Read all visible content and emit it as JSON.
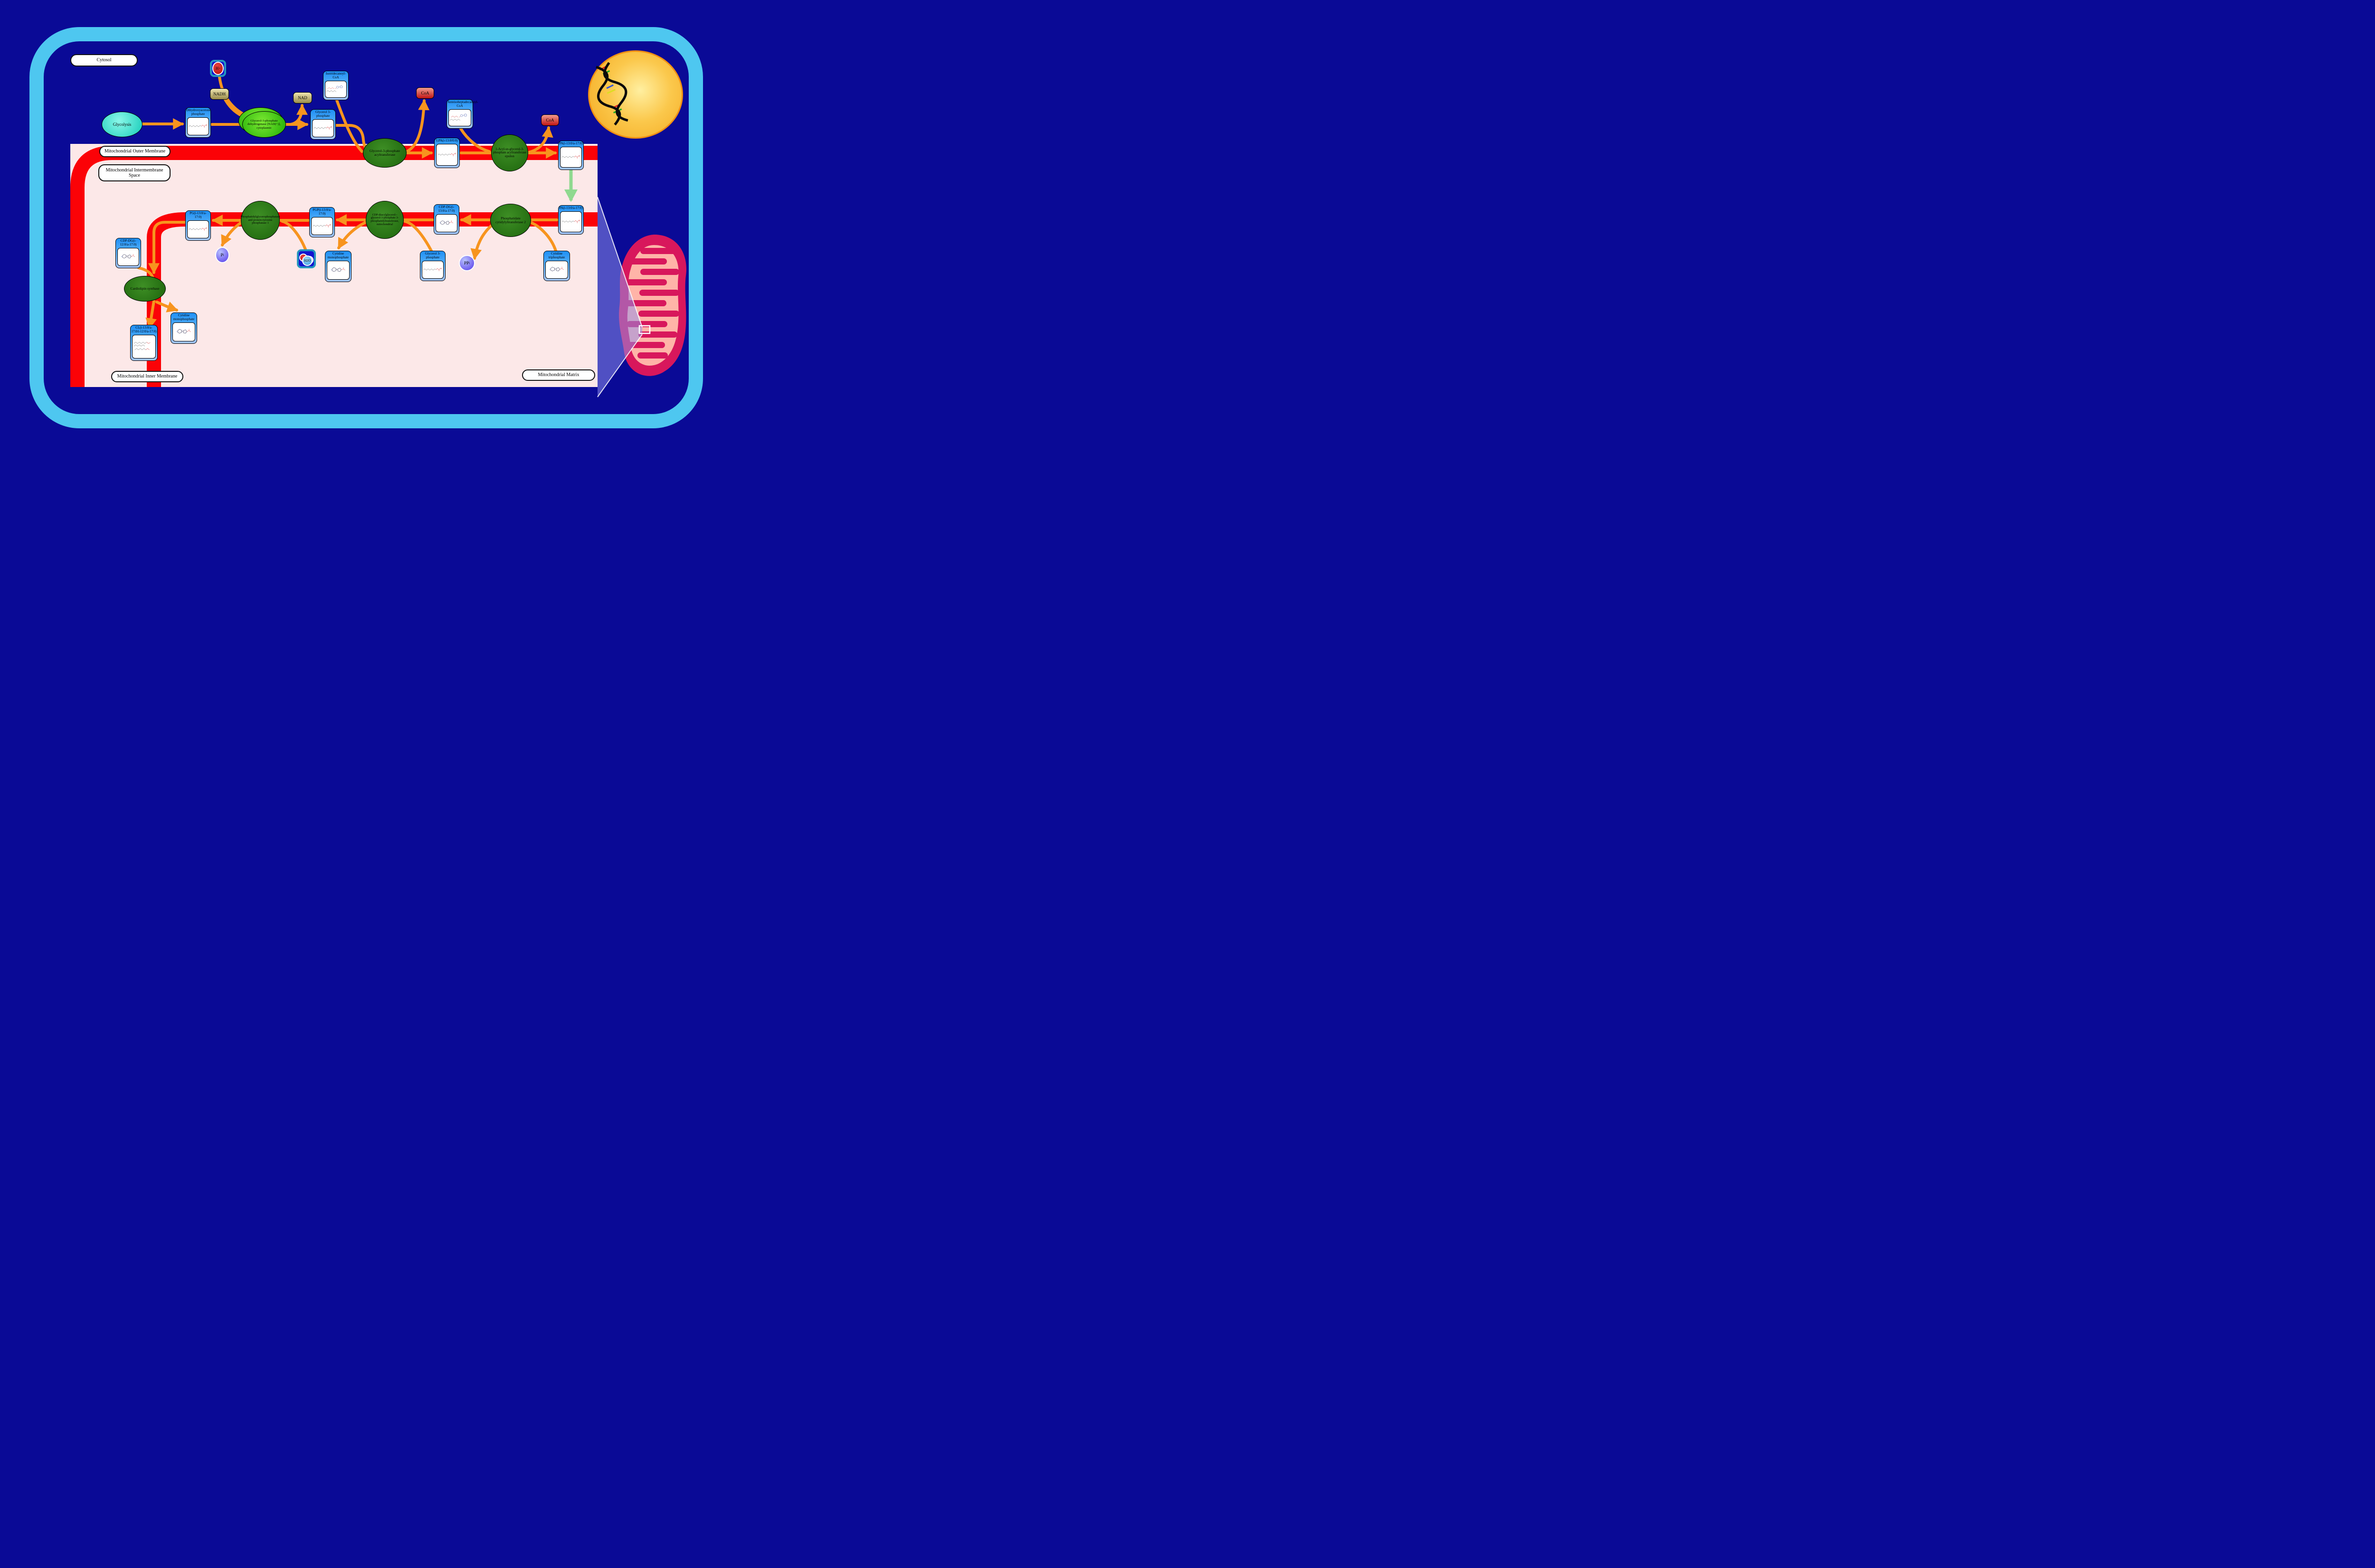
{
  "colors": {
    "background": "#0A0A96",
    "cell_membrane": "#4EC7F0",
    "intermembrane_space": "#FCE8E8",
    "membrane_band": "#FB0207",
    "reaction_arrow": "#F7941E",
    "transport_arrow": "#8FD98F",
    "metabolite_header": "#1E8FF5",
    "membrane_enzyme": "#2E7D1F",
    "cytosolic_enzyme": "#35D31A",
    "nucleus": "#F3A81E",
    "mitochondrion_outer": "#D8175C",
    "mitochondrion_matrix": "#FFB4A8"
  },
  "regions": {
    "cytosol": "Cytosol",
    "outer_membrane": "Mitochondrial Outer Membrane",
    "intermembrane_space": "Mitochondrial Intermembrane Space",
    "inner_membrane": "Mitochondrial Inner Membrane",
    "matrix": "Mitochondrial Matrix"
  },
  "pathway": {
    "glycolysis": "Glycolysis",
    "metabolites": {
      "dhap": "Dihydroxyacetone phosphate",
      "g3p_cytosol": "Glycerol 3-phosphate",
      "isotridecanoyl_coa": "Isotridecanoyl-CoA",
      "lpa": "LPA(i-13:0/0:0)",
      "anteisoheptadecanoyl_coa": "Anteisoheptadecanoyl-CoA",
      "pa_outer": "PA(i-13:0/a-17:0)",
      "pa_inner": "PA(i-13:0/a-17:0)",
      "cdp_dg_13": "CDP-DG(i-13:0/a-17:0)",
      "pgp": "PGP(i-13:0/a-17:0)",
      "pg": "PG(i-13:0/a-17:0)",
      "cdp_dg_12": "CDP-DG(i-12:0/a-17:0)",
      "cl": "CL(i-13:0/a-17:0/i-12:0/a-17:0)",
      "cmp_left": "Cytidine monophosphate",
      "cmp_middle": "Cytidine monophosphate",
      "g3p_matrix": "Glycerol 3-phosphate",
      "ctp": "Cytidine triphosphate"
    },
    "enzymes": {
      "g3p_dehydrogenase": "Glycerol-3-phosphate dehydrogenase [NAD(+)], cytoplasmic",
      "g3p_acyltransferase": "Glycerol-3-phosphate acyltransferase",
      "agpat_epsilon": "1-Acyl-sn-glycerol-3-phosphate acyltransferase epsilon",
      "phosphatidate_cytidylyltransferase": "Phosphatidate cytidylyltransferase 2",
      "cdp_dg_g3p_phosphatidyltransferase": "CDP-diacylglycerol--glycerol-3-phosphate 3-phosphatidyltransferase, mitochondrial",
      "pgp_phosphatase": "Phosphatidylglycerophosphatase and protein-tyrosine phosphatase 1",
      "cardiolipin_synthase": "Cardiolipin synthase"
    },
    "cofactors": {
      "nadh": "NADH",
      "nad": "NAD",
      "coa_1": "CoA",
      "coa_2": "CoA",
      "h_plus_base": "H",
      "h_plus_sup": "+",
      "h2o_h": "H",
      "h2o_sub": "2",
      "h2o_o": "O",
      "pi_base": "P",
      "pi_sub": "i",
      "ppi_base": "PP",
      "ppi_sub": "i"
    }
  }
}
